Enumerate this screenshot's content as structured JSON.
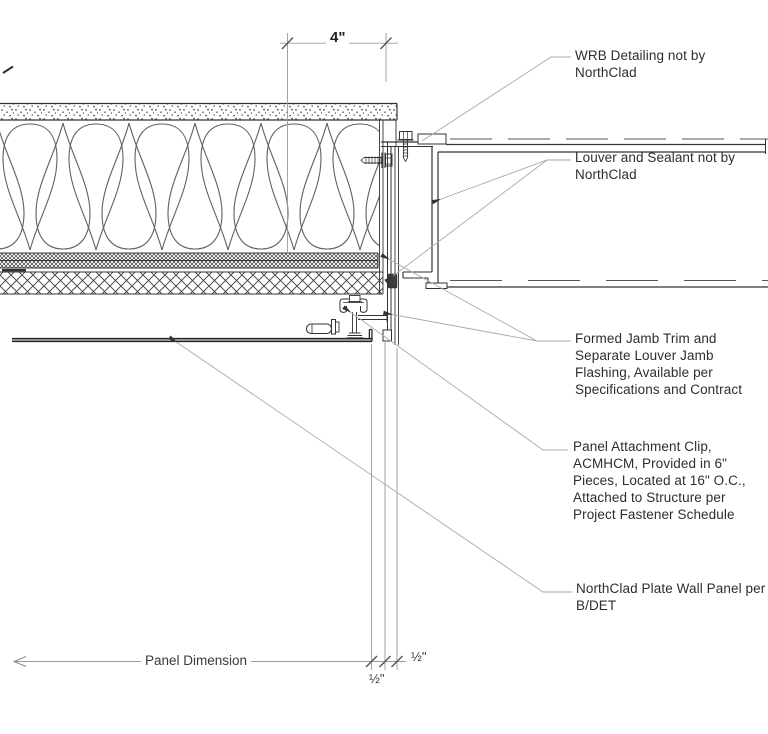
{
  "drawing": {
    "annotations": {
      "wrb": "WRB Detailing not by\nNorthClad",
      "louver_sealant": "Louver and Sealant not by\nNorthClad",
      "jamb_trim": "Formed Jamb Trim and\nSeparate Louver Jamb\nFlashing, Available per\nSpecifications and Contract",
      "attachment_clip": "Panel Attachment Clip,\nACMHCM, Provided in 6\"\nPieces, Located at 16\" O.C.,\nAttached to Structure per\nProject Fastener Schedule",
      "wall_panel": "NorthClad Plate Wall Panel per\nB/DET"
    },
    "dimensions": {
      "opening_offset": "4\"",
      "panel_dimension": "Panel Dimension",
      "gap_right": "½\"",
      "gap_lower": "½\""
    },
    "colors": {
      "background": "#ffffff",
      "line_dark": "#2e2e2e",
      "line_medium": "#555555",
      "line_light": "#9a9a9a",
      "text": "#2e2e2e"
    }
  }
}
